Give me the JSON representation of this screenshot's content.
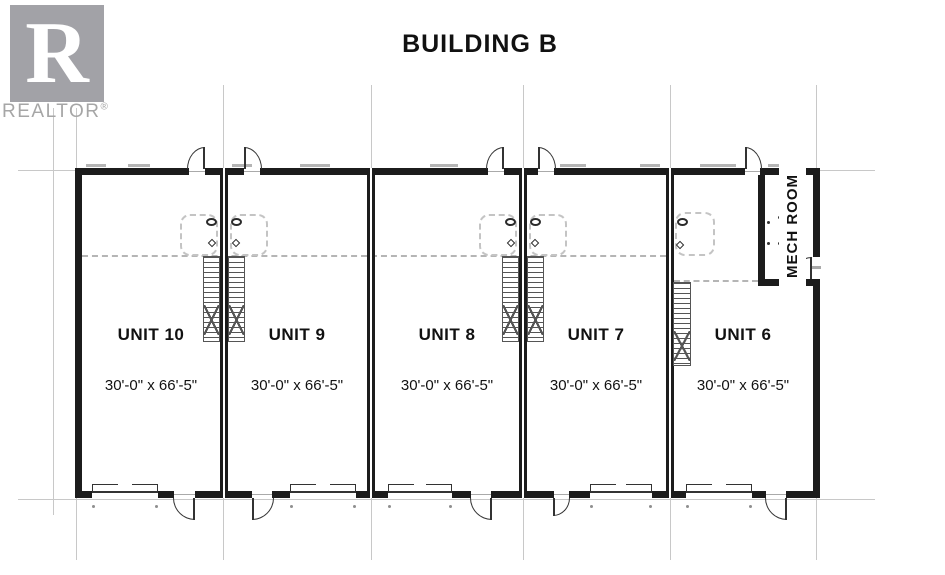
{
  "brand": {
    "logo_letter": "R",
    "name": "REALTOR",
    "registered_mark": "®"
  },
  "header": {
    "title": "BUILDING B"
  },
  "plan": {
    "mech_room_label": "MECH ROOM",
    "units": [
      {
        "name": "UNIT 10",
        "size": "30'-0\" x 66'-5\""
      },
      {
        "name": "UNIT 9",
        "size": "30'-0\" x 66'-5\""
      },
      {
        "name": "UNIT 8",
        "size": "30'-0\" x 66'-5\""
      },
      {
        "name": "UNIT 7",
        "size": "30'-0\" x 66'-5\""
      },
      {
        "name": "UNIT 6",
        "size": "30'-0\" x 66'-5\""
      }
    ]
  },
  "colors": {
    "wall": "#1c1c1c",
    "grid_line": "#c8c8c8",
    "dashed_line": "#b5b5b5",
    "door_line": "#333333",
    "logo_gray": "#a2a2a7",
    "brand_text_gray": "#a6a6a6",
    "text": "#111111"
  }
}
